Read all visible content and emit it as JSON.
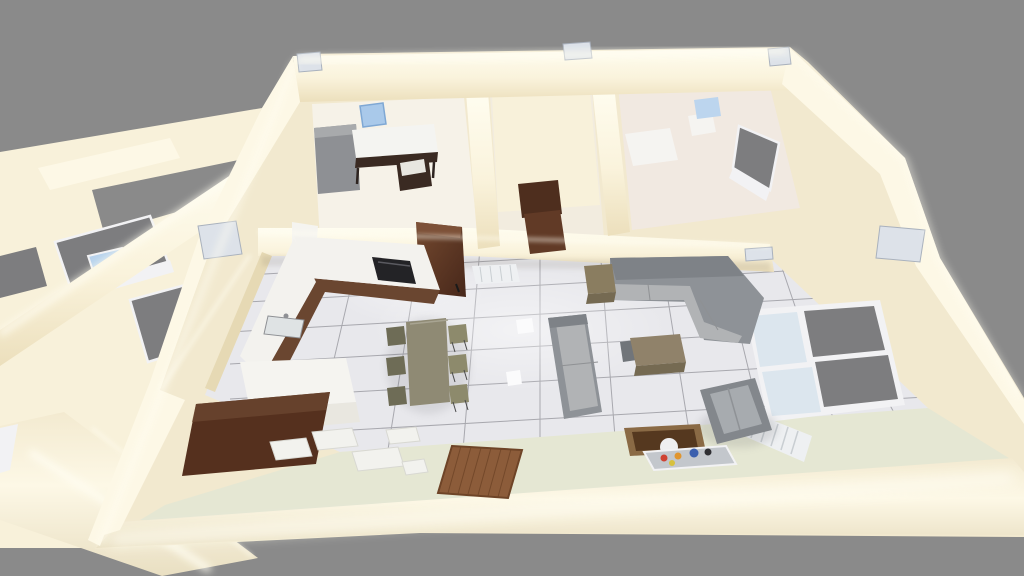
{
  "scene": {
    "type": "3d-floorplan-render",
    "description": "Bird's-eye oblique 3D render of a furnished apartment with glowing cream walls, white tiled floor and gray backdrop",
    "view": "top-down perspective"
  },
  "palette": {
    "bg": "#8a8a8a",
    "wallBase": "#f2e9cf",
    "wallFace": "#f8f1da",
    "wallBright": "#fdf8e6",
    "wallGlow": "#fffdf2",
    "wallShadow": "#e6d9b4",
    "tileFloor": "#e8e8ec",
    "grout": "#74747c",
    "greenFloor": "#e5e7d3",
    "bedroomFloor": "#f6f2e8",
    "hallFloor": "#f2ecdf",
    "bathFloor": "#eee3d9",
    "closetFloor": "#efe8d6",
    "counterWhite": "#f3f2ee",
    "islandWhite": "#f5f4f0",
    "woodDark": "#4e2c1d",
    "woodMid": "#6a4630",
    "woodLight": "#7d5138",
    "sideboardWood": "#55301e",
    "cooktopBlack": "#232326",
    "sinkSteel": "#dfe3e4",
    "tableTaupe": "#8f8a74",
    "chairOlive": "#8d8a6c",
    "chairBack": "#6e6c56",
    "chairLeg": "#4a4a4a",
    "sofaBase": "#8e9297",
    "sofaSeat": "#b1b3b5",
    "sofaBack": "#7e8287",
    "armchairBase": "#83878c",
    "armchairCushion": "#a7abaf",
    "sideTable": "#8a7d60",
    "coffeeTable": "#90826a",
    "coffeeFront": "#756a52",
    "matWood": "#8c5c3a",
    "matLine": "#6e4427",
    "boxTan": "#8a6a45",
    "boxInner": "#55381f",
    "ballWhite": "#efeff0",
    "tray": "#c3c7cc",
    "dotRed": "#cf4232",
    "dotOrange": "#e0952f",
    "dotBlue": "#3b5fae",
    "dotYellow": "#d7c13e",
    "dotDark": "#2f2f33",
    "glassGray": "#7d7d7f",
    "glassLight": "#dce6ee",
    "glassBlue": "#b7d2ec",
    "frameWhite": "#f2f2f4",
    "doorWood": "#613a26",
    "doorLintel": "#4e2e1e",
    "plate": "#dde2e9",
    "plateBorder": "#a9b1bd",
    "deskWhite": "#f4f4f1",
    "deskFrame": "#3a2a22",
    "chairBlue": "#a9c9ea",
    "chairBlueEdge": "#7fa8d4",
    "grayCabinet": "#8e9094",
    "radiator": "#eef0f2",
    "radiatorSlat": "#c9ced2",
    "tileWhite": "#f2f2ee",
    "tileEdge": "#d8d8d2"
  },
  "rooms": [
    {
      "id": "bedroom",
      "label": "Bedroom with desk"
    },
    {
      "id": "hallway",
      "label": "Hallway"
    },
    {
      "id": "closet",
      "label": "Closet nook"
    },
    {
      "id": "bathroom",
      "label": "Bathroom"
    },
    {
      "id": "kitchen",
      "label": "Kitchen"
    },
    {
      "id": "dining",
      "label": "Dining area"
    },
    {
      "id": "living",
      "label": "Living room"
    },
    {
      "id": "terrace",
      "label": "Front floor edge"
    }
  ],
  "furniture": {
    "desk": "Desk with white top",
    "deskChair": "Desk chair",
    "blueChair": "Blue office chair",
    "grayCabinet": "Gray cabinet",
    "tallCabinet": "Tall walnut cabinet",
    "counter": "L-shaped kitchen counter",
    "island": "White kitchen island",
    "cooktop": "Black cooktop",
    "sink": "Kitchen sink",
    "sideboard": "Walnut TV sideboard",
    "looseTiles": "Loose white tiles",
    "diningTable": "Dining table",
    "diningChairs": "Six dining chairs",
    "wallUnit": "White wall radiator unit",
    "sofa": "Gray two-seat sofa",
    "cornerSofa": "Gray corner sectional sofa",
    "sideTable": "Side table",
    "coffeeTable": "Coffee table",
    "smallChair": "Small gray chair",
    "armchair": "Gray armchair",
    "storageBox": "Storage box with ball",
    "tray": "Serving tray with colorful items",
    "mat": "Wooden floor mat",
    "windowLiving": "Large living-room window",
    "windowBath": "Bathroom window",
    "windowsWing": "Left wing windows",
    "radiator": "Window radiator",
    "bathtub": "Bathtub",
    "basin": "Wash basin",
    "blueStool": "Blue stool",
    "door": "Dark wood interior door",
    "floorLamp": "Floor light",
    "plates": "Metal wall-top junction plates"
  }
}
